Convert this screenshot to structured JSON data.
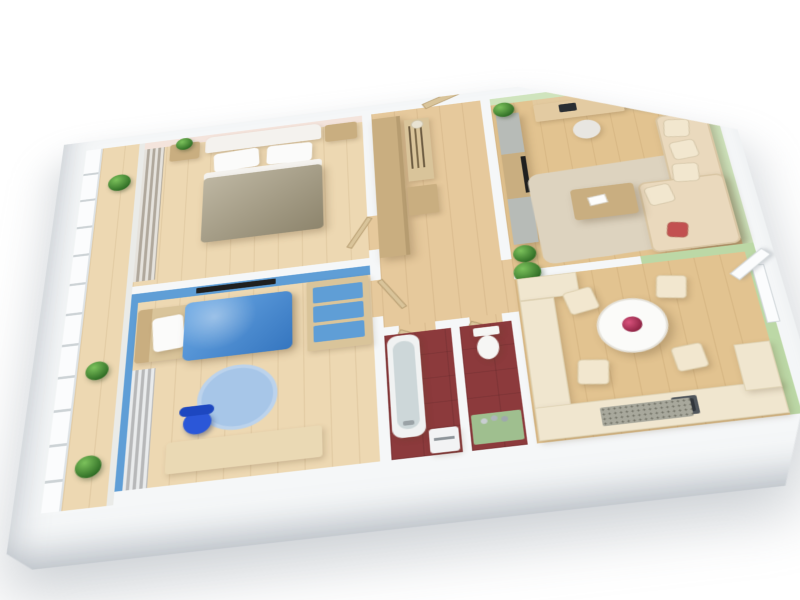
{
  "scene": {
    "kind": "3d-apartment-floorplan-render",
    "description": "Isometric cutaway 3D render of a two-bedroom apartment floor plan on a white background",
    "background": "#ffffff"
  },
  "palette": {
    "exterior_wall": "#f5f7f8",
    "wood_floor": "#e2c390",
    "wood_floor_light": "#edd8b2",
    "hall_floor": "#e6c99c",
    "master_wall_pink": "#f4e4dc",
    "kids_wall_blue": "#5f9ed6",
    "kids_duvet_blue": "#4190dd",
    "kids_rug_blue": "#a7c6e8",
    "kids_chair_blue": "#2b57d8",
    "master_duvet_khaki": "#a59b7f",
    "living_wall_green": "#cfe4bd",
    "dining_wall_green": "#bcd8a6",
    "bath_floor_maroon": "#8c3a3c",
    "closet_floor": "#efe8d4",
    "furniture_tan": "#c9ae80",
    "desk_wood": "#ead9b4",
    "desk_wood_light": "#e3cba2",
    "cream_sofa": "#ead9bd",
    "cushion_cream": "#f2e7cf",
    "cream_kitchen": "#f0e6cf",
    "rug_beige": "#ddd3bf",
    "table_white": "#fbfbf9",
    "flower_red": "#b5365a",
    "accent_cushion_red": "#c25050",
    "mat_gray": "#a8a89c",
    "wc_mat_green": "#9fbf8f",
    "curtain_gray": "#c6bfb2",
    "curtain_kids": "#cfd3d6",
    "plant_green": "#4f9b3e",
    "tv_black": "#1f1f1f",
    "gray_cabinet": "#b7bbb7",
    "tub_white": "#f0f2f2",
    "tub_inner": "#cdd7d9",
    "toilet_white": "#f6f6f4",
    "appliance_white": "#f2f3f4",
    "monitor_dark": "#2a2e33",
    "sink_dark": "#50565c",
    "office_chair_white": "#e8e6e1",
    "balcony_glass": "#e9eff1",
    "window_white": "#fbfcfd",
    "headboard_white": "#f4f2ee",
    "pillow_white": "#fbfbfa",
    "bedframe_tan": "#d9c49a"
  },
  "rooms": [
    {
      "id": "balcony",
      "label": "Balcony",
      "items": [
        "window-wall",
        "potted-plants",
        "wood-floor"
      ]
    },
    {
      "id": "master-bedroom",
      "label": "Master bedroom",
      "items": [
        "double-bed",
        "white-headboard",
        "two-pillows",
        "khaki-duvet",
        "nightstand-left",
        "nightstand-right",
        "plant",
        "gray-curtains",
        "pink-accent-wall"
      ]
    },
    {
      "id": "kids-bedroom",
      "label": "Kids bedroom",
      "items": [
        "single-bed",
        "blue-duvet",
        "white-pillow",
        "round-blue-rug",
        "desk",
        "blue-chair",
        "shelf-unit-blue-drawers",
        "wall-tv",
        "curtains",
        "blue-walls"
      ]
    },
    {
      "id": "hallway",
      "label": "Hallway",
      "items": [
        "tall-wardrobe",
        "coat-rack-with-hangers",
        "hat",
        "shoe-bench",
        "entry-door"
      ]
    },
    {
      "id": "living-room",
      "label": "Living room",
      "items": [
        "corner-sofa",
        "cream-cushions",
        "red-accent-cushion",
        "coffee-table",
        "magazine",
        "beige-area-rug",
        "media-wall-unit",
        "tv",
        "computer-desk",
        "monitor",
        "office-chair",
        "seascape-painting",
        "potted-plants",
        "green-walls"
      ]
    },
    {
      "id": "kitchen-dining",
      "label": "Kitchen and dining",
      "items": [
        "round-dining-table",
        "red-flower-centerpiece",
        "four-cream-chairs",
        "l-shaped-kitchen-counter",
        "dark-sink",
        "speckled-floor-mat",
        "open-window",
        "green-accent-wall"
      ]
    },
    {
      "id": "bathroom",
      "label": "Bathroom",
      "items": [
        "bathtub",
        "washing-machine",
        "maroon-tile-floor"
      ]
    },
    {
      "id": "wc",
      "label": "WC",
      "items": [
        "toilet",
        "green-mat",
        "toiletries",
        "maroon-tile-floor"
      ]
    },
    {
      "id": "closet",
      "label": "Closet",
      "items": [
        "shelving"
      ]
    }
  ]
}
